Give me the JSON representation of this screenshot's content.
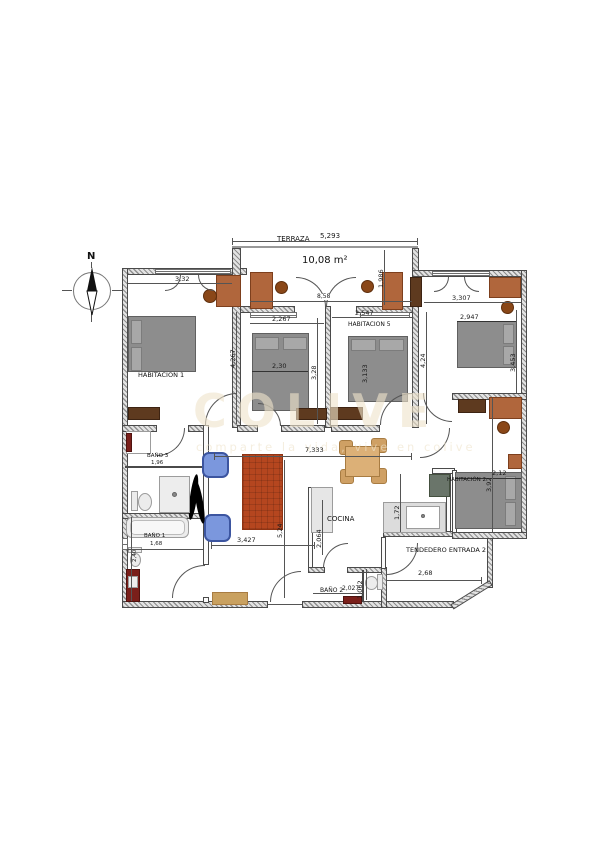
{
  "compass": {
    "north": "N"
  },
  "watermark": {
    "logo": "COLIVE",
    "tagline": "comparte la vida, vive en colive"
  },
  "rooms": {
    "terraza": {
      "label": "TERRAZA",
      "area": "10,08 m²"
    },
    "habitacion1": {
      "label": "HABITACION 1"
    },
    "habitacion5": {
      "label": "HABITACION 5"
    },
    "habitacion2": {
      "label": "HABITACIÓN 2"
    },
    "cocina": {
      "label": "COCINA"
    },
    "bano1": {
      "label": "BAÑO 1"
    },
    "bano2": {
      "label": "BAÑO 2"
    },
    "bano3": {
      "label": "BAÑO 3"
    },
    "tendedero": {
      "label": "TENDEDERO ENTRADA 2"
    }
  },
  "dims": {
    "terraza_width": "5,293",
    "terraza_depth": "1,986",
    "terraza_wall": "8,58",
    "h1_width": "3,32",
    "h1_depth": "4,267",
    "mid_width": "2,267",
    "mid_bed": "2,30",
    "mid_depth": "3,28",
    "h5_width": "2,547",
    "h5_bed": "3,133",
    "h5_hall": "4,24",
    "tr_width": "3,307",
    "tr_bed": "2,947",
    "tr_depth": "3,453",
    "h2_depth": "3,92",
    "h2_width": "2,12",
    "salon_width": "7,333",
    "salon_depth": "5,24",
    "salon_lower": "3,427",
    "cocina_depth": "2,064",
    "cocina_side": "1,72",
    "bano3_width": "1,96",
    "bano1_width": "1,68",
    "bano1_depth": "2,40",
    "bano2_width": "2,027",
    "bano2_depth": "1,062",
    "tendedero_width": "2,68"
  },
  "colors": {
    "wall_gray": "#4a4a4a",
    "bed_gray": "#8d8d8d",
    "wood_sienna": "#b0663c",
    "wood_dark": "#5e3a1f",
    "rug_brick": "#b5461f",
    "chair_blue": "#7b97dd",
    "dining_tan": "#cfa064",
    "vanity_red": "#7a1f1a",
    "watermark_beige": "#efe3cb"
  }
}
